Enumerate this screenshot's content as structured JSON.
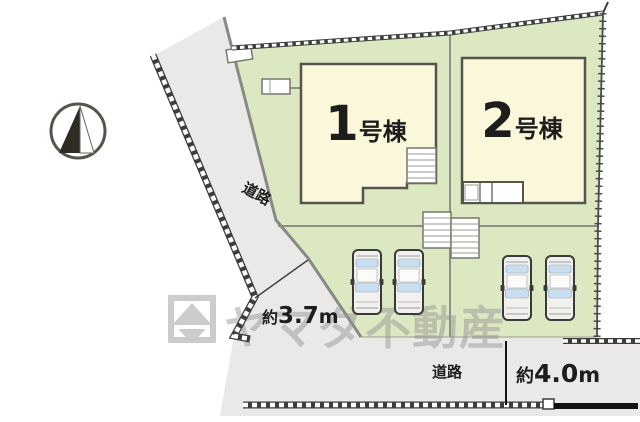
{
  "compass": {
    "icon": "north-arrow-icon"
  },
  "buildings": [
    {
      "number": "1",
      "suffix": "号棟"
    },
    {
      "number": "2",
      "suffix": "号棟"
    }
  ],
  "roads": {
    "left": {
      "label": "道路"
    },
    "bottom": {
      "label": "道路"
    }
  },
  "measurements": {
    "left_road_width": {
      "prefix": "約",
      "value": "3.7",
      "unit": "m"
    },
    "bottom_road_width": {
      "prefix": "約",
      "value": "4.0",
      "unit": "m"
    }
  },
  "watermark": {
    "text": "ヤマダ不動産",
    "logo_icon": "yamada-logo"
  },
  "parking": {
    "car_count": 4
  },
  "colors": {
    "lot_green": "#dce8c2",
    "building_cream": "#faf7da",
    "road_gray": "#ebe9e8",
    "outline_dark": "#4a4a46",
    "car_window_blue": "#c9dff0",
    "watermark_gray": "#8f8f8f"
  }
}
